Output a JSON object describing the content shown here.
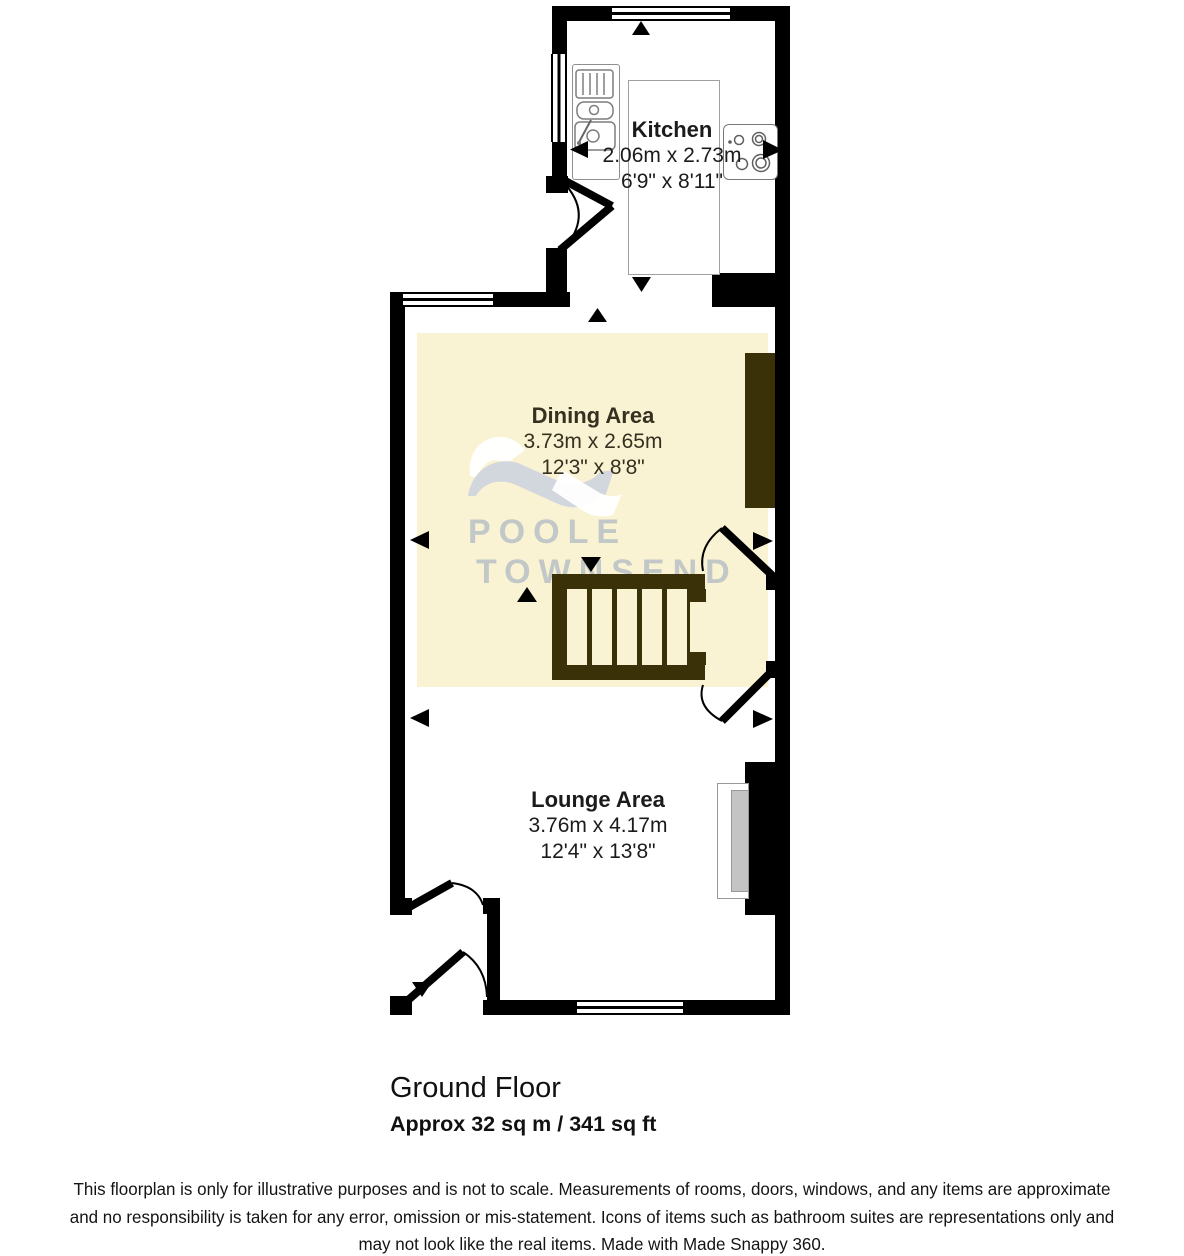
{
  "title": "Ground Floor Floorplan",
  "rooms": {
    "kitchen": {
      "name": "Kitchen",
      "metric": "2.06m x 2.73m",
      "imperial": "6'9\" x 8'11\""
    },
    "dining": {
      "name": "Dining Area",
      "metric": "3.73m x 2.65m",
      "imperial": "12'3\" x 8'8\""
    },
    "lounge": {
      "name": "Lounge Area",
      "metric": "3.76m x 4.17m",
      "imperial": "12'4\" x 13'8\""
    }
  },
  "watermark": {
    "line1": "POOLE",
    "line2": "TOWNSEND"
  },
  "footer": {
    "floor_label": "Ground Floor",
    "area_label": "Approx 32 sq m / 341 sq ft",
    "disclaimer_lines": [
      "This floorplan is only for illustrative purposes and is not to scale. Measurements of rooms, doors, windows, and any items are approximate",
      "and no responsibility is taken for any error, omission or mis-statement. Icons of items such as bathroom suites are representations only and",
      "may not look like the real items. Made with Made Snappy 360."
    ]
  },
  "colors": {
    "wall": "#000000",
    "room_fill": "#faf3d3",
    "feature_dark": "#3a3108",
    "watermark_text": "#b9c3d2",
    "watermark_logo_gray": "#cdd3de"
  },
  "icons": {
    "sink": "sink-icon",
    "hob": "hob-icon",
    "stairs": "stairs-icon",
    "fireplace": "fireplace-icon",
    "door_swing": "door-swing-icon",
    "window": "window-icon",
    "measure_arrow": "measure-arrow-icon",
    "logo": "watermark-logo-icon"
  }
}
